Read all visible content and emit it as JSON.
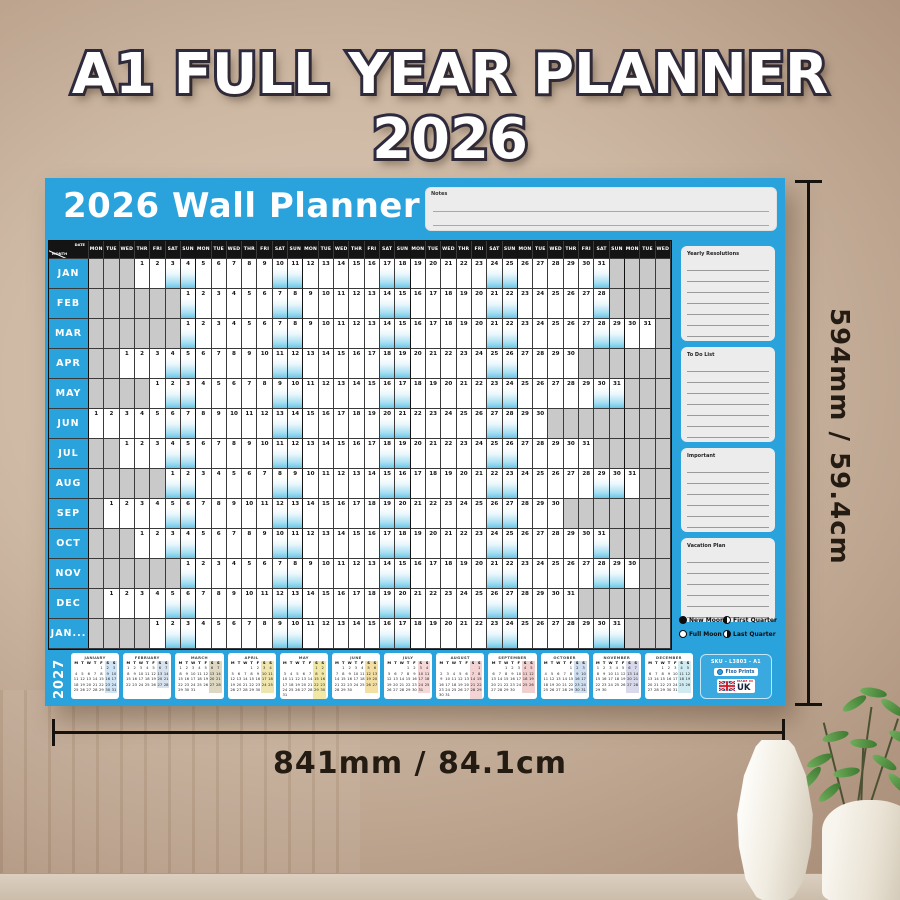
{
  "title": "A1 FULL YEAR PLANNER 2026",
  "poster": {
    "header": {
      "title": "2026 Wall Planner",
      "notes_label": "Notes"
    },
    "grid": {
      "corner": {
        "top": "DATE",
        "bottom": "MONTH"
      },
      "day_names": [
        "MON",
        "TUE",
        "WED",
        "THR",
        "FRI",
        "SAT",
        "SUN"
      ],
      "day_columns": 38,
      "months": [
        {
          "label": "JAN",
          "offset": 3,
          "days": 31
        },
        {
          "label": "FEB",
          "offset": 6,
          "days": 28
        },
        {
          "label": "MAR",
          "offset": 6,
          "days": 31
        },
        {
          "label": "APR",
          "offset": 2,
          "days": 30
        },
        {
          "label": "MAY",
          "offset": 4,
          "days": 31
        },
        {
          "label": "JUN",
          "offset": 0,
          "days": 30
        },
        {
          "label": "JUL",
          "offset": 2,
          "days": 31
        },
        {
          "label": "AUG",
          "offset": 5,
          "days": 31
        },
        {
          "label": "SEP",
          "offset": 1,
          "days": 30
        },
        {
          "label": "OCT",
          "offset": 3,
          "days": 31
        },
        {
          "label": "NOV",
          "offset": 6,
          "days": 30
        },
        {
          "label": "DEC",
          "offset": 1,
          "days": 31
        },
        {
          "label": "JAN...",
          "offset": 4,
          "days": 31
        }
      ]
    },
    "side_panel": {
      "sections": [
        {
          "title": "Yearly Resolutions",
          "lines": 7
        },
        {
          "title": "To Do List",
          "lines": 7
        },
        {
          "title": "Important",
          "lines": 6
        },
        {
          "title": "Vacation Plan",
          "lines": 6
        }
      ],
      "legend": [
        {
          "icon": "new-moon",
          "label": "New Moon"
        },
        {
          "icon": "first-quarter",
          "label": "First Quarter"
        },
        {
          "icon": "full-moon",
          "label": "Full Moon"
        },
        {
          "icon": "last-quarter",
          "label": "Last Quarter"
        }
      ]
    },
    "bottom": {
      "year": "2027",
      "day_letters": [
        "M",
        "T",
        "W",
        "T",
        "F",
        "S",
        "S"
      ],
      "mini_months": [
        {
          "name": "JANUARY",
          "offset": 4,
          "days": 31,
          "highlight": "#cfe4f4"
        },
        {
          "name": "FEBRUARY",
          "offset": 0,
          "days": 28,
          "highlight": "#d7e2ee"
        },
        {
          "name": "MARCH",
          "offset": 0,
          "days": 31,
          "highlight": "#ded8c2"
        },
        {
          "name": "APRIL",
          "offset": 3,
          "days": 30,
          "highlight": "#efe5ae"
        },
        {
          "name": "MAY",
          "offset": 5,
          "days": 31,
          "highlight": "#f2e8a6"
        },
        {
          "name": "JUNE",
          "offset": 1,
          "days": 30,
          "highlight": "#f4dfa2"
        },
        {
          "name": "JULY",
          "offset": 3,
          "days": 31,
          "highlight": "#f5d7d7"
        },
        {
          "name": "AUGUST",
          "offset": 6,
          "days": 31,
          "highlight": "#f3d3d3"
        },
        {
          "name": "SEPTEMBER",
          "offset": 2,
          "days": 30,
          "highlight": "#f1cfcf"
        },
        {
          "name": "OCTOBER",
          "offset": 4,
          "days": 31,
          "highlight": "#cfdff0"
        },
        {
          "name": "NOVEMBER",
          "offset": 0,
          "days": 30,
          "highlight": "#d9d9ec"
        },
        {
          "name": "DECEMBER",
          "offset": 2,
          "days": 31,
          "highlight": "#cfeaf1"
        }
      ],
      "sku_box": {
        "sku": "SKU - L3803 - A1",
        "brand": "Fixo Prints",
        "made_in": "MADE IN",
        "country": "UK"
      }
    }
  },
  "dimensions": {
    "height_label": "594mm / 59.4cm",
    "width_label": "841mm / 84.1cm"
  },
  "colors": {
    "poster_blue": "#2aa3dd",
    "grid_black": "#141414",
    "weekend_blue": "#6ac7e8",
    "empty_gray": "#c9c9c9"
  }
}
